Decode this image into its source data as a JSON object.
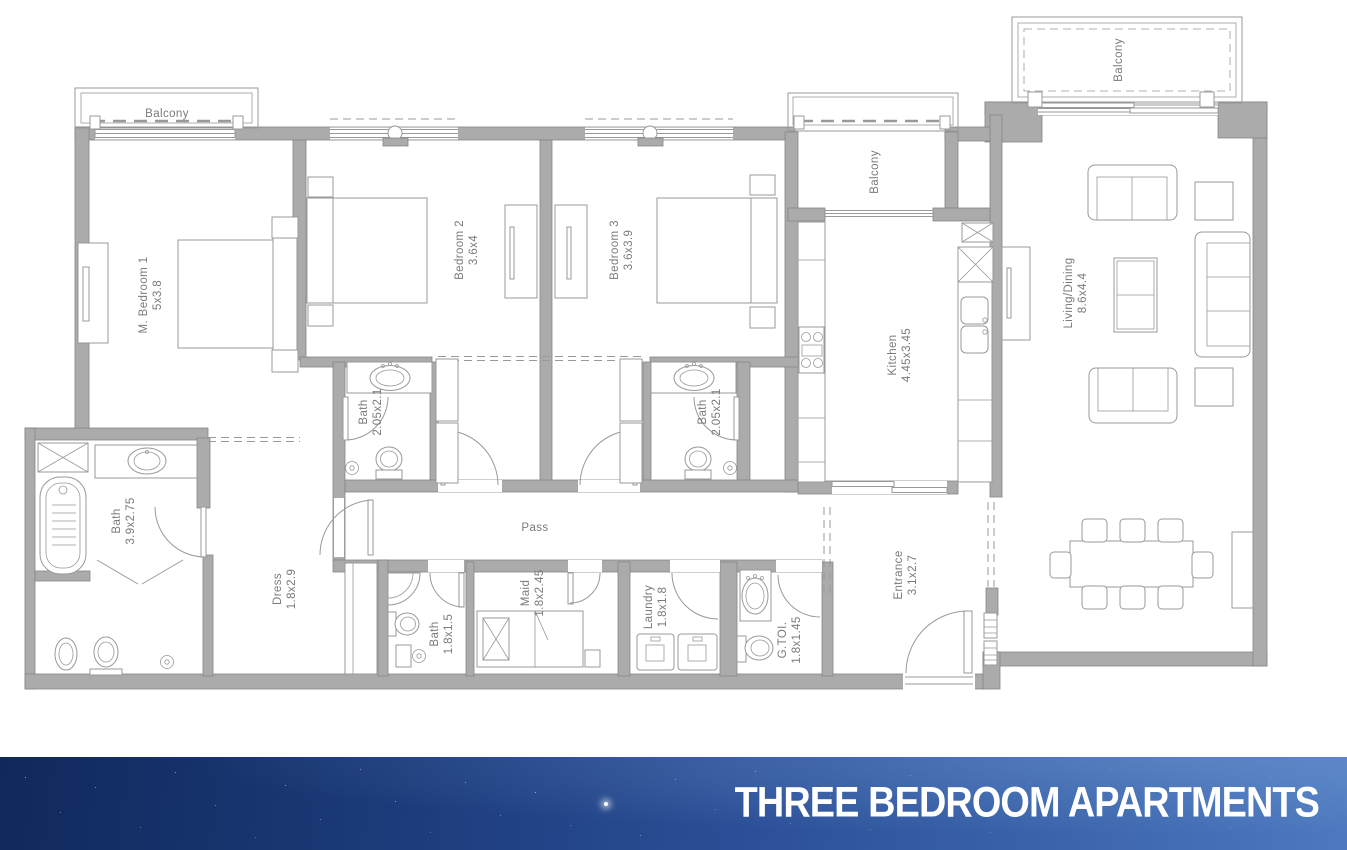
{
  "footer": {
    "title": "THREE BEDROOM APARTMENTS"
  },
  "plan": {
    "balcony_master": {
      "name": "Balcony"
    },
    "balcony_middle": {
      "name": "Balcony"
    },
    "balcony_living": {
      "name": "Balcony"
    },
    "m_bedroom1": {
      "name": "M. Bedroom 1",
      "dims": "5x3.8"
    },
    "bedroom2": {
      "name": "Bedroom 2",
      "dims": "3.6x4"
    },
    "bedroom3": {
      "name": "Bedroom 3",
      "dims": "3.6x3.9"
    },
    "kitchen": {
      "name": "Kitchen",
      "dims": "4.45x3.45"
    },
    "living_dining": {
      "name": "Living/Dining",
      "dims": "8.6x4.4"
    },
    "bath_bedroom2": {
      "name": "Bath",
      "dims": "2.05x2.1"
    },
    "bath_bedroom3": {
      "name": "Bath",
      "dims": "2.05x2.1"
    },
    "bath_master": {
      "name": "Bath",
      "dims": "3.9x2.75"
    },
    "dress": {
      "name": "Dress",
      "dims": "1.8x2.9"
    },
    "pass": {
      "name": "Pass"
    },
    "bath_maid": {
      "name": "Bath",
      "dims": "1.8x1.5"
    },
    "maid": {
      "name": "Maid",
      "dims": "1.8x2.45"
    },
    "laundry": {
      "name": "Laundry",
      "dims": "1.8x1.8"
    },
    "g_toilet": {
      "name": "G.TOI.",
      "dims": "1.8x1.45"
    },
    "entrance": {
      "name": "Entrance",
      "dims": "3.1x2.7"
    }
  },
  "colors": {
    "wall": "#ababab",
    "line": "#999999",
    "label": "#7a7a7a",
    "banner_start": "#10295c",
    "banner_end": "#4d79bf",
    "title": "#ffffff"
  }
}
